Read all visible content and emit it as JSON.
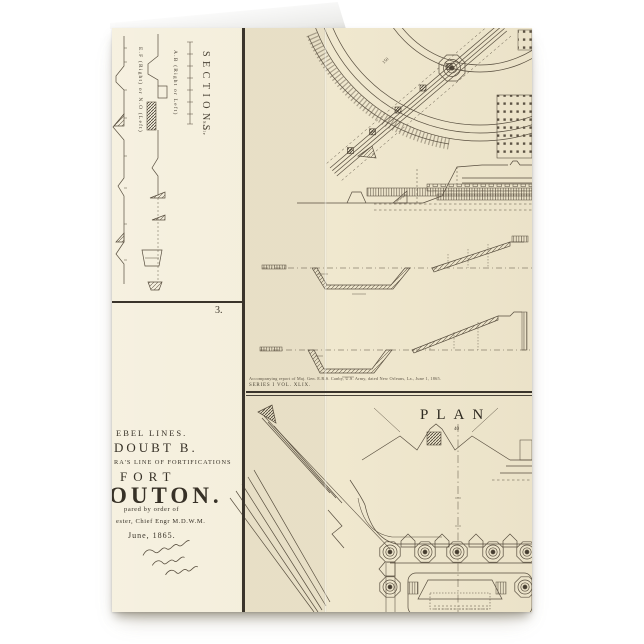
{
  "page": {
    "background": "#ffffff"
  },
  "card": {
    "paper_color": "#f0e8cf",
    "ink_color": "#584e3f",
    "divider_color": "#3a342b"
  },
  "sections_panel": {
    "title": "SECTIONS",
    "scale_label": "Scale",
    "label_ab": "A.B (Right or Left)",
    "label_ef": "E.F (Right) or N.O (Left)"
  },
  "title_panel": {
    "figure_number": "3.",
    "line1": "EBEL LINES.",
    "line2": "DOUBT B.",
    "line3": "RA'S LINE OF FORTIFICATIONS",
    "line4": "FORT",
    "line5": "OUTON.",
    "line6": "pared by order of",
    "line7": "ester, Chief Engr M.D.W.M.",
    "line8": "June, 1865."
  },
  "report_note": {
    "line1": "Accompanying report of Maj. Gen. E.R.S. Canby, U.S. Army, dated New Orleans, La., June 1, 1865.",
    "line2": "SERIES I VOL. XLIX."
  },
  "top_plan": {
    "arc_label": "150"
  },
  "plan_panel": {
    "title": "PLAN",
    "sublabel": "40"
  }
}
